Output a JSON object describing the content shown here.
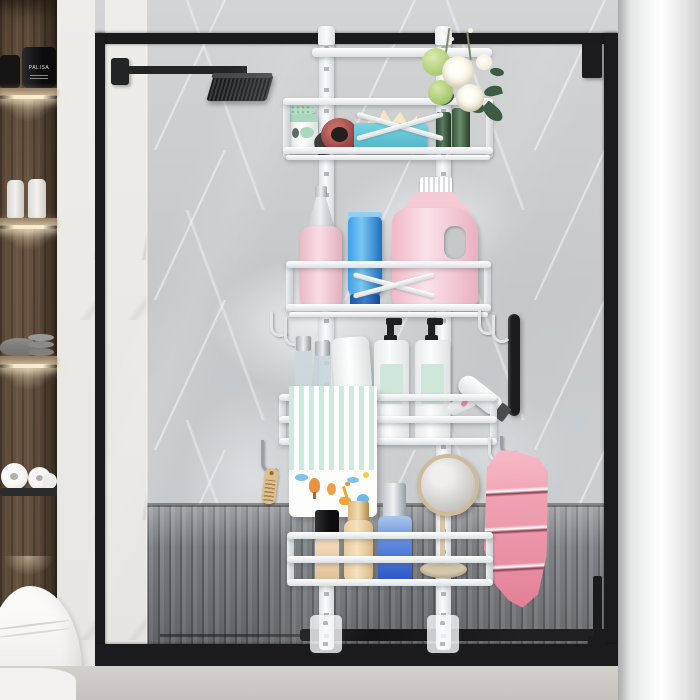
{
  "meta": {
    "type": "product-photo",
    "description": "White adjustable over-door hanging shower caddy with four baskets and hooks, mounted on a black framed glass shower door in a marble bathroom with wooden shelving, toiletries, towels and a rainfall shower head"
  },
  "labels": {
    "jar": "PALISA"
  },
  "palette": {
    "frameBlack": "#1b1b1d",
    "armBlack": "#232426",
    "wallGray": "#c7c9cb",
    "marbleWhite": "#edebe8",
    "woodDark": "#6a5440",
    "ledGlow": "#f7e9c9",
    "caddyWhite": "#f4f5f7",
    "slatFloor": "#7c7f82",
    "trackBlack": "#141416",
    "bathFloor": "#cbc8c3",
    "pillarWhite": "#f4f4f4",
    "jarBlack": "#151515",
    "items": {
      "soapDishMint": "#b9e2c6",
      "dispenserMint": "#a9d8bd",
      "darkTool": "#3b3c3f",
      "redJar": "#9a4745",
      "tissueTeal": "#58c2d4",
      "tissueCream": "#f3e8c6",
      "vaseGreen": "#3c5a41",
      "roseWhite": "#f6f3e8",
      "hydrangeaGreen": "#b8d284",
      "leafGreen": "#3e5c44",
      "sprayPink": "#f0c3cf",
      "tubeBlue": "#2e8fd8",
      "detergentPink": "#f5c9d5",
      "pumpBlack": "#1f2022",
      "pumpLabelMint": "#cfe6da",
      "towelStripeMint": "#cdeade",
      "dryerNozzle": "#4a4c4f",
      "combTan": "#dcc08e",
      "foundationCap": "#1a1a1c",
      "foundationNude": "#ecd2ae",
      "goldBottle": "#e0be8d",
      "blueBottle": "#3f74d8",
      "mirrorFrameTan": "#cdbb9c",
      "mirrorStemTan": "#d6c7a9",
      "dishTan": "#ddd3b8",
      "towelPink": "#f0a2b2"
    }
  },
  "objects": [
    "left wood cabinet with black jars, white bottles, gray bowls, toilet paper",
    "white toilet",
    "marble pillars",
    "black shower frame and glass door",
    "rainfall shower head",
    "door handle",
    "slatted shower floor",
    "over-door caddy: two adjustable rails, four white baskets, side hooks, floor feet",
    "basket1: soap dish, soap dispenser, red jar, tissue box, green vases, white roses and green hydrangeas",
    "basket2: pink pump bottle, blue tube, pink detergent jug",
    "basket3: perfume bottles, white tube, two shampoo pump bottles, hair dryer, striped cartoon towel, comb on hook",
    "basket4: foundation, gold bottle, blue serum bottle, vanity mirror, trinket dish, pink towel on hook"
  ]
}
